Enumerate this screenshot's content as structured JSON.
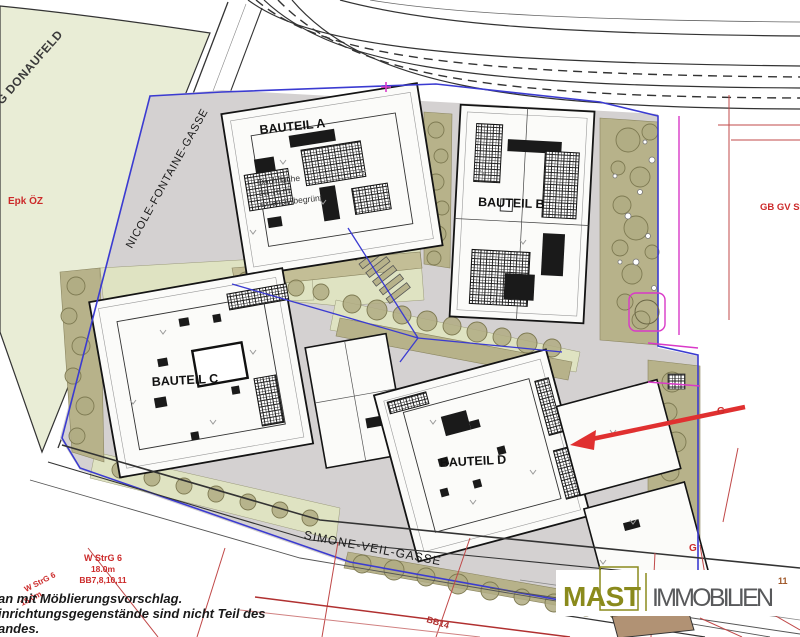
{
  "plan": {
    "area_label": "UG DONAUFELD",
    "zone_label": "Epk ÖZ",
    "streets": {
      "nicole": "NICOLE-FONTAINE-GASSE",
      "simone": "SIMONE-VEIL-GASSE"
    },
    "buildings": {
      "a": "BAUTEIL A",
      "b": "BAUTEIL B",
      "c": "BAUTEIL C",
      "d": "BAUTEIL D"
    },
    "roof_note": {
      "line1": "Dachfläche",
      "line2": "30-76 m",
      "line3": "extensiv begrünt"
    },
    "zoning": {
      "right_label": "GB GV StrG",
      "g_upper": "G",
      "g_lower": "G",
      "w_strg": "W StrG 6",
      "height": "18.0m",
      "bb_list": "BB7,8,10,11",
      "w_strg_rot": "W StrG 6",
      "height_rot": "18.0m",
      "bb14": "BB14"
    },
    "notes": {
      "line1": "an mit Möblierungsvorschlag.",
      "line2": "inrichtungsgegenstände sind nicht Teil des",
      "line3": "andes."
    },
    "logo": {
      "mast": "MAST",
      "immobilien": "IMMOBILIEN",
      "superscript": "11"
    },
    "colors": {
      "park_green": "#e9edd6",
      "strip_olive": "#b7b28a",
      "light_green": "#dfe3c2",
      "boundary_blue": "#3b3bd1",
      "magenta": "#d939c8",
      "red": "#cc2a2a",
      "arrow_red": "#e03030",
      "logo_olive": "#8a8a1c",
      "logo_gray": "#58595b"
    }
  }
}
